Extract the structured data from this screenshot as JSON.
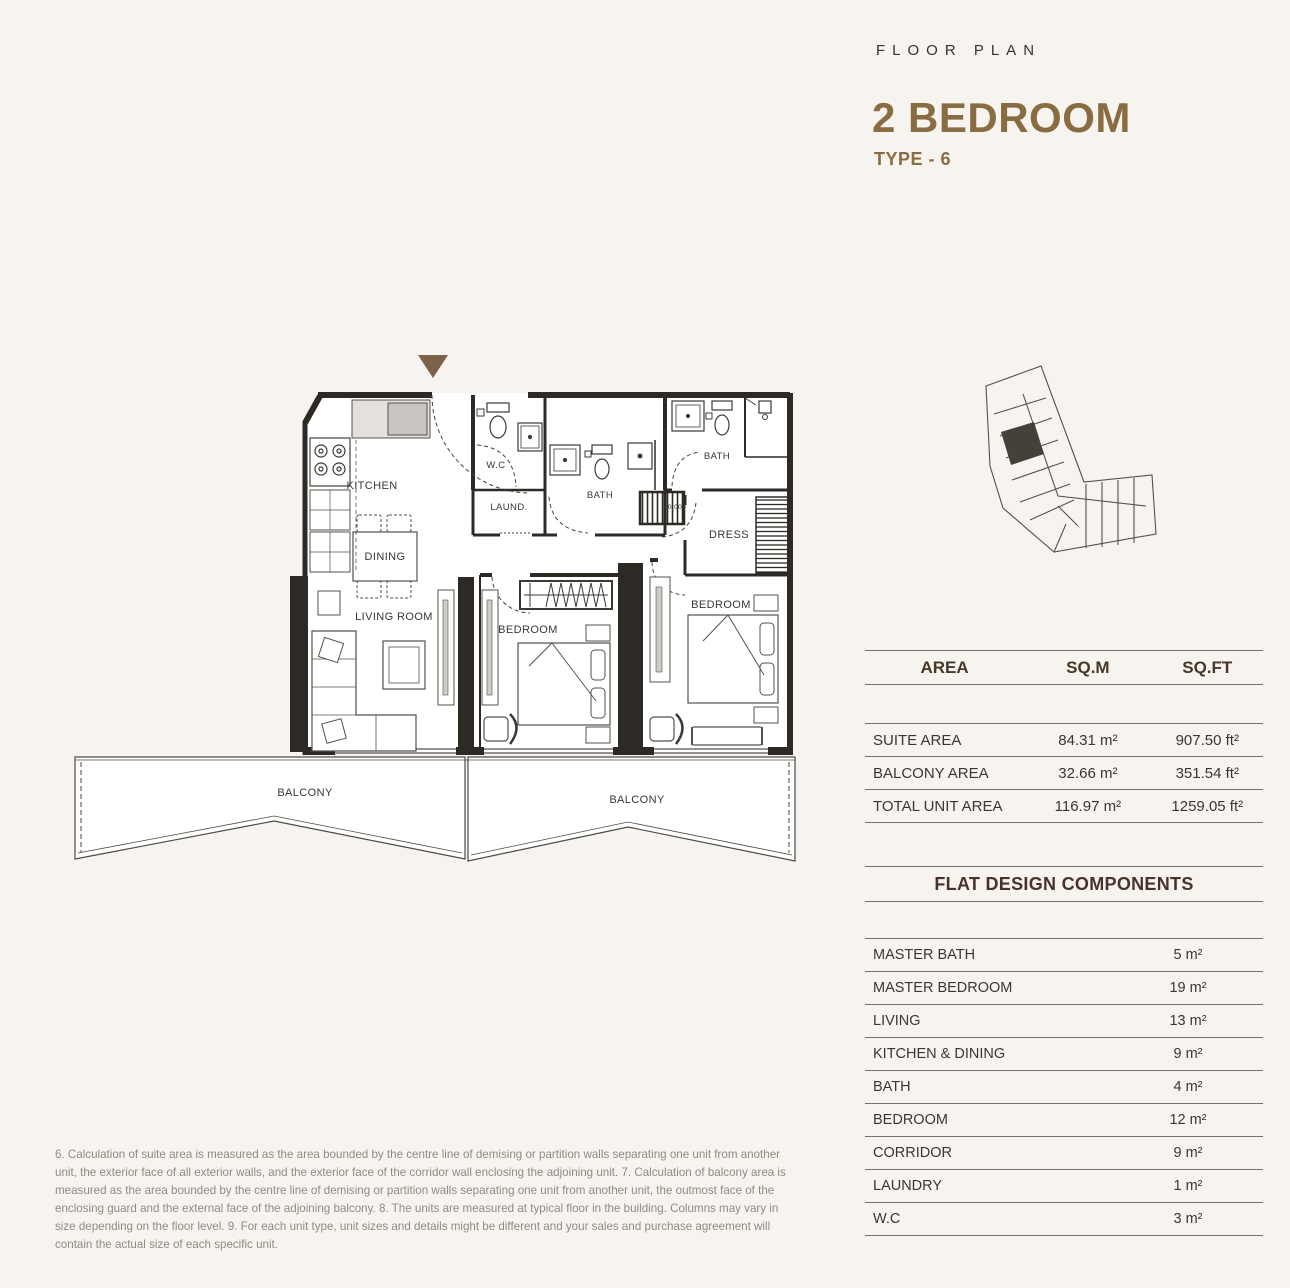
{
  "colors": {
    "background": "#f7f4f0",
    "accent_brown": "#8a6c42",
    "wall": "#2d2a26",
    "marker_brown": "#7a6148"
  },
  "header": {
    "eyebrow": "FLOOR PLAN",
    "title": "2 BEDROOM",
    "subtitle": "TYPE - 6"
  },
  "floor_plan": {
    "labels": {
      "kitchen": "KITCHEN",
      "wc": "W.C",
      "laundry": "LAUND.",
      "bath_small": "BATH",
      "bath_master": "BATH",
      "dress": "DRESS",
      "dining": "DINING",
      "living": "LIVING ROOM",
      "bedroom_mid": "BEDROOM",
      "bedroom_master": "BEDROOM",
      "balcony_left": "BALCONY",
      "balcony_right": "BALCONY",
      "level_marker": "0.000"
    }
  },
  "area_table": {
    "headers": {
      "area": "AREA",
      "sqm": "SQ.M",
      "sqft": "SQ.FT"
    },
    "rows": [
      {
        "label": "SUITE AREA",
        "sqm": "84.31 m²",
        "sqft": "907.50 ft²"
      },
      {
        "label": "BALCONY AREA",
        "sqm": "32.66 m²",
        "sqft": "351.54 ft²"
      },
      {
        "label": "TOTAL UNIT AREA",
        "sqm": "116.97 m²",
        "sqft": "1259.05  ft²"
      }
    ]
  },
  "components_table": {
    "title": "FLAT DESIGN COMPONENTS",
    "rows": [
      {
        "label": "MASTER BATH",
        "value": "5 m²"
      },
      {
        "label": "MASTER BEDROOM",
        "value": "19 m²"
      },
      {
        "label": "LIVING",
        "value": "13 m²"
      },
      {
        "label": "KITCHEN & DINING",
        "value": "9 m²"
      },
      {
        "label": "BATH",
        "value": "4 m²"
      },
      {
        "label": "BEDROOM",
        "value": "12 m²"
      },
      {
        "label": "CORRIDOR",
        "value": "9 m²"
      },
      {
        "label": "LAUNDRY",
        "value": "1 m²"
      },
      {
        "label": "W.C",
        "value": "3 m²"
      }
    ]
  },
  "disclaimer": "6. Calculation of suite area is measured as the area bounded by the centre line of demising or partition walls separating one unit from another unit, the exterior face of all exterior walls, and the exterior face of the corridor wall enclosing the adjoining unit.  7. Calculation of balcony area is measured as the area bounded by the centre line of demising or partition walls separating one unit from another unit, the outmost face of the enclosing guard and the external face of the adjoining balcony. 8. The units are measured at typical floor in the building. Columns may vary in size depending on the floor level. 9. For each unit type, unit sizes and details might be different and your sales and purchase agreement will contain the actual size of each specific unit."
}
